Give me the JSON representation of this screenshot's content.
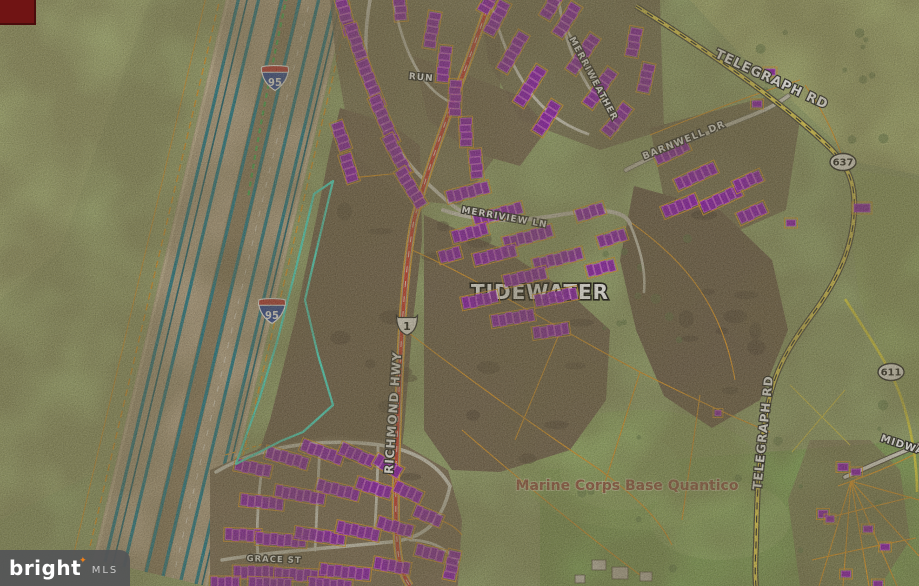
{
  "watermark": {
    "brand": "bright",
    "suffix": "MLS",
    "sparkle": "✦",
    "sparkle_color": "#f08019"
  },
  "colors": {
    "parcel_highlight": "#46e8cf",
    "parcel_line": "#e2951f",
    "building_fill": "#8a10b0",
    "building_stroke": "#d54ae8",
    "interstate_blue": "#1f3f9e",
    "interstate_red": "#c42828",
    "us_route_white": "#f5f2ea",
    "highway_lane_teal": "#1d7888",
    "richmond_red": "#cf3526",
    "telegraph_yellow": "#e8d44a",
    "corner_tag": "#701414"
  },
  "route_shields": [
    {
      "kind": "interstate",
      "number": "95",
      "x": 275,
      "y": 78
    },
    {
      "kind": "interstate",
      "number": "95",
      "x": 272,
      "y": 311
    },
    {
      "kind": "us_route",
      "number": "1",
      "x": 407,
      "y": 325
    },
    {
      "kind": "secondary_oval",
      "number": "637",
      "x": 843,
      "y": 162
    },
    {
      "kind": "secondary_oval",
      "number": "611",
      "x": 891,
      "y": 372
    }
  ],
  "road_labels": [
    {
      "text": "TELEGRAPH RD",
      "x": 770,
      "y": 83,
      "rot": 25,
      "size": 13
    },
    {
      "text": "TELEGRAPH RD",
      "x": 767,
      "y": 433,
      "rot": -84,
      "size": 12
    },
    {
      "text": "RICHMOND HWY",
      "x": 397,
      "y": 413,
      "rot": -86,
      "size": 12
    },
    {
      "text": "MERRIVIEW LN",
      "x": 504,
      "y": 220,
      "rot": 10,
      "size": 9
    },
    {
      "text": "BARNWELL DR",
      "x": 685,
      "y": 143,
      "rot": -22,
      "size": 9.5
    },
    {
      "text": "MERRIWEATHER",
      "x": 591,
      "y": 80,
      "rot": 62,
      "size": 9
    },
    {
      "text": "RUN",
      "x": 421,
      "y": 80,
      "rot": 5,
      "size": 9
    },
    {
      "text": "GRACE ST",
      "x": 274,
      "y": 562,
      "rot": 2,
      "size": 8.5
    },
    {
      "text": "MIDWAY",
      "x": 905,
      "y": 449,
      "rot": 18,
      "size": 10
    }
  ],
  "place_labels": [
    {
      "text": "TIDEWATER",
      "x": 540,
      "y": 299,
      "size": 20,
      "style": "big",
      "under_buildings": true
    },
    {
      "text": "Marine Corps Base Quantico",
      "x": 627,
      "y": 490,
      "size": 14,
      "style": "brown",
      "under_buildings": false
    }
  ]
}
